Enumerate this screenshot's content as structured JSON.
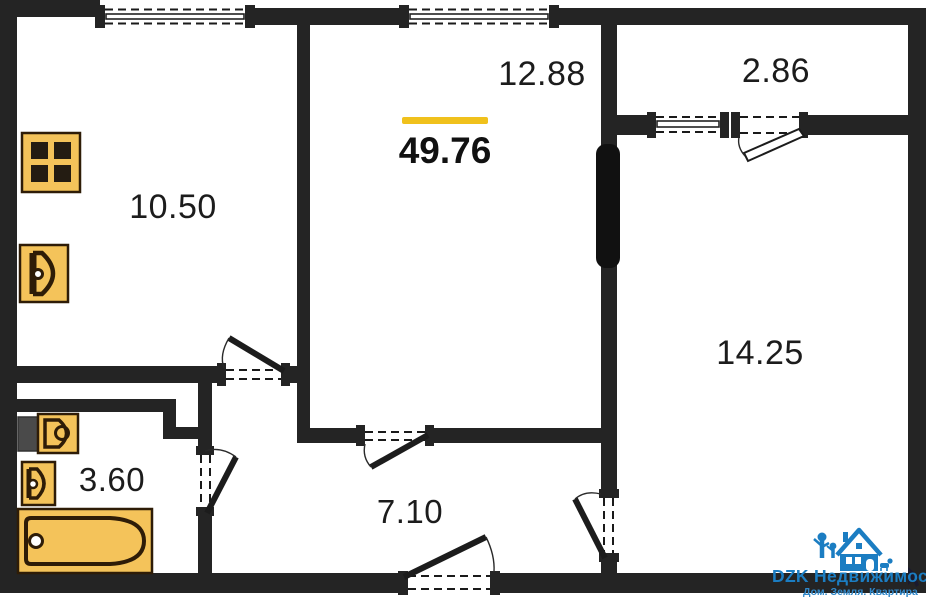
{
  "plan": {
    "total_area": "49.76",
    "rooms": [
      {
        "id": "kitchen",
        "area": "10.50"
      },
      {
        "id": "living",
        "area": "12.88"
      },
      {
        "id": "balcony",
        "area": "2.86"
      },
      {
        "id": "bedroom",
        "area": "14.25"
      },
      {
        "id": "bathroom",
        "area": "3.60"
      },
      {
        "id": "hallway",
        "area": "7.10"
      }
    ],
    "fixtures": [
      "stove-icon",
      "kitchen-sink-icon",
      "toilet-icon",
      "bathroom-sink-icon",
      "bathtub-icon"
    ],
    "colors": {
      "wall": "#242424",
      "fixture_fill": "#f4c35a",
      "fixture_stroke": "#2e1c07",
      "accent_underline": "#f0c11c",
      "watermark_blue": "#1b7dc2",
      "background": "#ffffff"
    }
  },
  "watermark": {
    "brand": "DZK Недвижимость",
    "tagline": "Дом. Земля. Квартира",
    "logo": "house-logo-icon"
  }
}
